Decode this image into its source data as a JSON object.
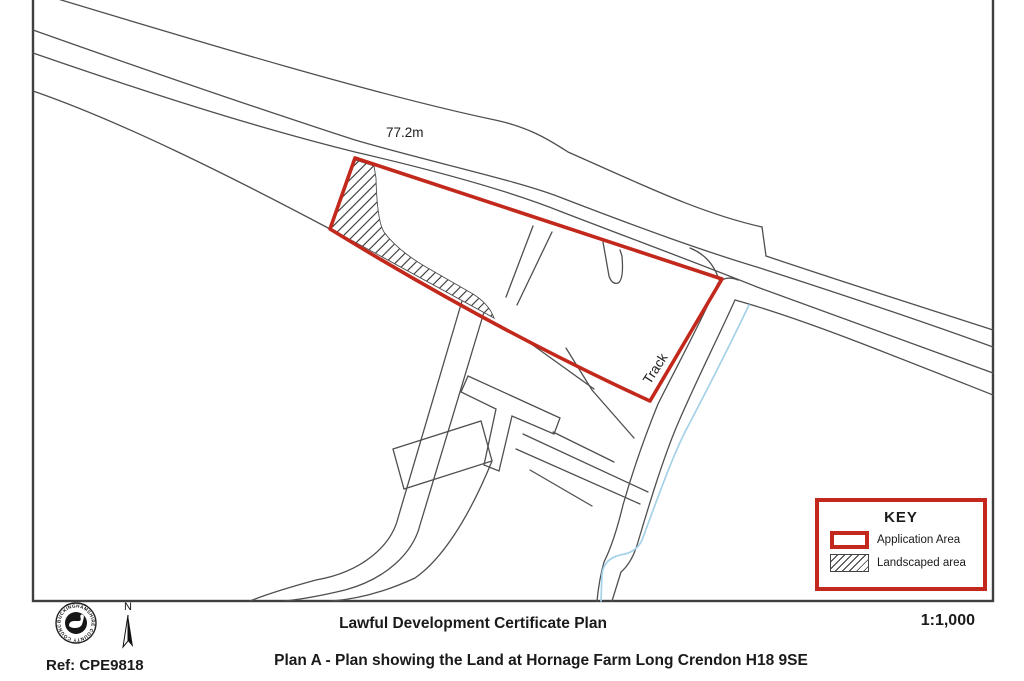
{
  "map": {
    "spot_height_label": "77.2m",
    "track_label": "Track",
    "key": {
      "title": "KEY",
      "items": [
        {
          "id": "application-area",
          "label": "Application Area",
          "swatch": "red-outline"
        },
        {
          "id": "landscaped-area",
          "label": "Landscaped area",
          "swatch": "diagonal-hatch"
        }
      ]
    },
    "colors": {
      "application_area": "#c2291c",
      "road_lines": "#4f4f4f",
      "stream": "#a5d2e8",
      "frame": "#3f3f3f"
    }
  },
  "footer": {
    "logo_ring_text": "BUCKINGHAMSHIRE COUNTY COUNCIL",
    "north_label": "N",
    "ref_label": "Ref: CPE9818",
    "title": "Lawful Development Certificate Plan",
    "subtitle": "Plan A - Plan showing the Land at Hornage Farm Long Crendon H18 9SE",
    "scale_label": "1:1,000"
  }
}
